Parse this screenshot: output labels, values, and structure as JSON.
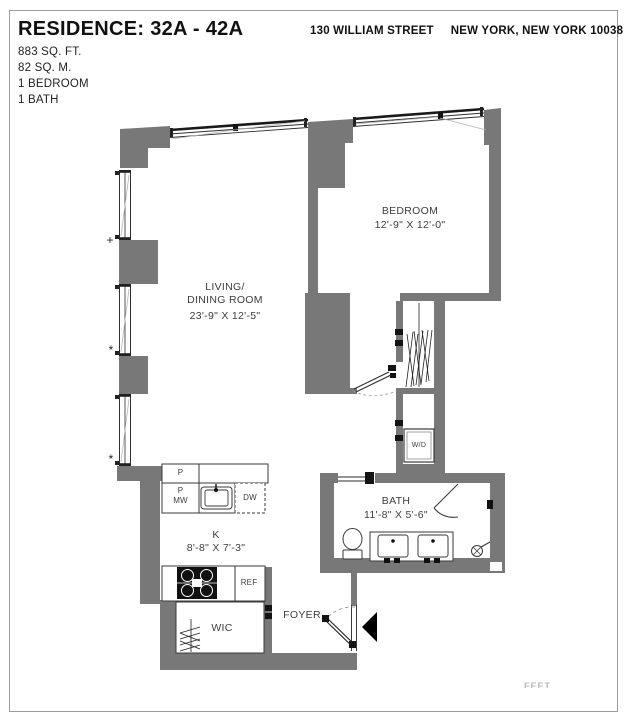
{
  "header": {
    "residence_title": "RESIDENCE: 32A - 42A",
    "area_sqft": "883 SQ. FT.",
    "area_sqm": "82 SQ. M.",
    "bedrooms": "1 BEDROOM",
    "baths": "1 BATH",
    "address_street": "130 WILLIAM STREET",
    "address_city": "NEW YORK, NEW YORK 10038"
  },
  "plan": {
    "rooms": {
      "living": {
        "line1": "LIVING/",
        "line2": "DINING ROOM",
        "dims": "23'-9\" X 12'-5\""
      },
      "bedroom": {
        "name": "BEDROOM",
        "dims": "12'-9\" X 12'-0\""
      },
      "bath": {
        "name": "BATH",
        "dims": "11'-8\" X 5'-6\""
      },
      "kitchen": {
        "name": "K",
        "dims": "8'-8\" X 7'-3\""
      },
      "wic": {
        "name": "WIC"
      },
      "foyer": {
        "name": "FOYER"
      }
    },
    "fixtures": {
      "washer_dryer": "W/D",
      "pantry": "P",
      "pantry_mw_line1": "P",
      "pantry_mw_line2": "MW",
      "dishwasher": "DW",
      "refrigerator": "REF"
    },
    "window_symbols": {
      "plus": "+",
      "star": "*"
    }
  },
  "footer": {
    "partial_text": "FEET"
  },
  "colors": {
    "wall_gray": "#787878",
    "line_dark": "#3a3a3a",
    "accent_black": "#111111"
  }
}
